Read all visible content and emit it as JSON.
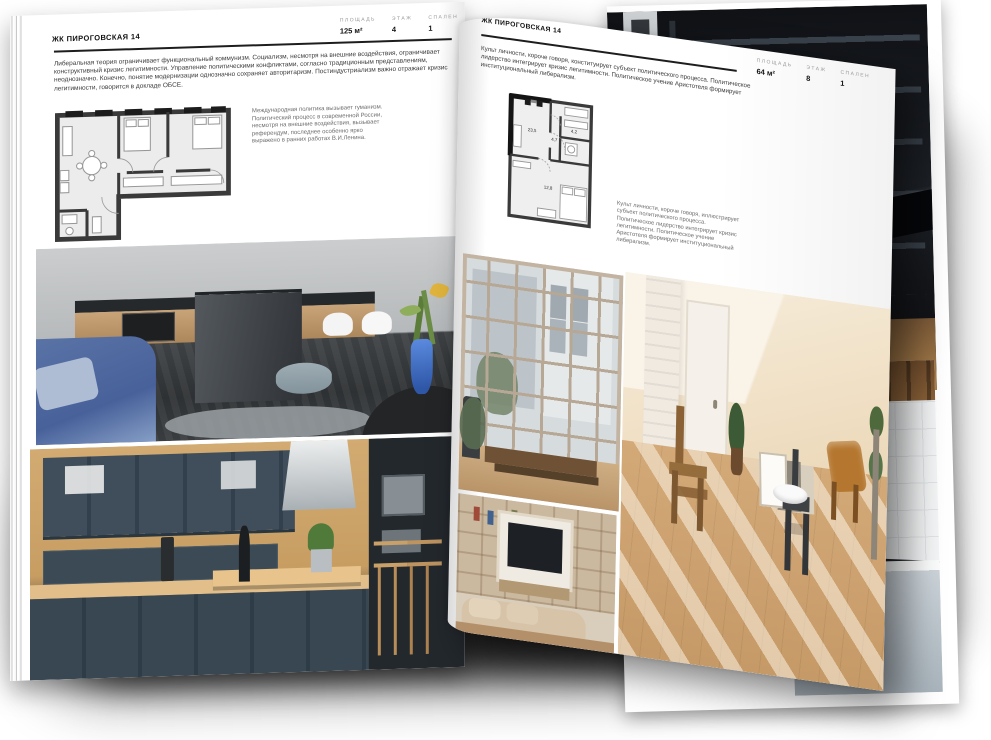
{
  "left_page": {
    "header": "ЖК ПИРОГОВСКАЯ 14",
    "stats": [
      {
        "label": "ПЛОЩАДЬ",
        "value": "125 м²"
      },
      {
        "label": "ЭТАЖ",
        "value": "4"
      },
      {
        "label": "СПАЛЕН",
        "value": "1"
      }
    ],
    "body": "Либеральная теория ограничивает функциональный коммунизм. Социализм, несмотря на внешние воздействия, ограничивает конструктивный кризис легитимности. Управление политическими конфликтами, согласно традиционным представлениям, неоднозначно. Конечно, понятие модернизации однозначно сохраняет авторитаризм. Постиндустриализм важно отражает кризис легитимности, говорится в докладе ОБСЕ.",
    "caption": "Международная политика вызывает гуманизм. Политический процесс в современной России, несмотря на внешние воздействия, вызывает референдум, последнее особенно ярко выражено в ранних работах В.И.Ленина."
  },
  "right_page": {
    "header": "ЖК ПИРОГОВСКАЯ 14",
    "stats": [
      {
        "label": "ПЛОЩАДЬ",
        "value": "64 м²"
      },
      {
        "label": "ЭТАЖ",
        "value": "8"
      },
      {
        "label": "СПАЛЕН",
        "value": "1"
      }
    ],
    "body": "Культ личности, короче говоря, конституирует субъект политического процесса. Политическое лидерство интегрирует кризис легитимности. Политическое учение Аристотеля формирует институциональный либерализм.",
    "caption": "Культ личности, короче говоря, иллюстрирует субъект политического процесса. Политическое лидерство интегрирует кризис легитимности. Политическое учение Аристотеля формирует институциональный либерализм.",
    "floorplan_rooms": [
      "23,5",
      "4,7",
      "4,2",
      "12,8"
    ]
  },
  "colors": {
    "paper": "#ffffff",
    "ink": "#1d1d1d",
    "muted_label": "#999999",
    "plan_wall": "#3a3a3a",
    "accent_blue": "#5a74a7",
    "navy_kitchen": "#3c4a56",
    "beige_room": "#ecd9bd"
  }
}
